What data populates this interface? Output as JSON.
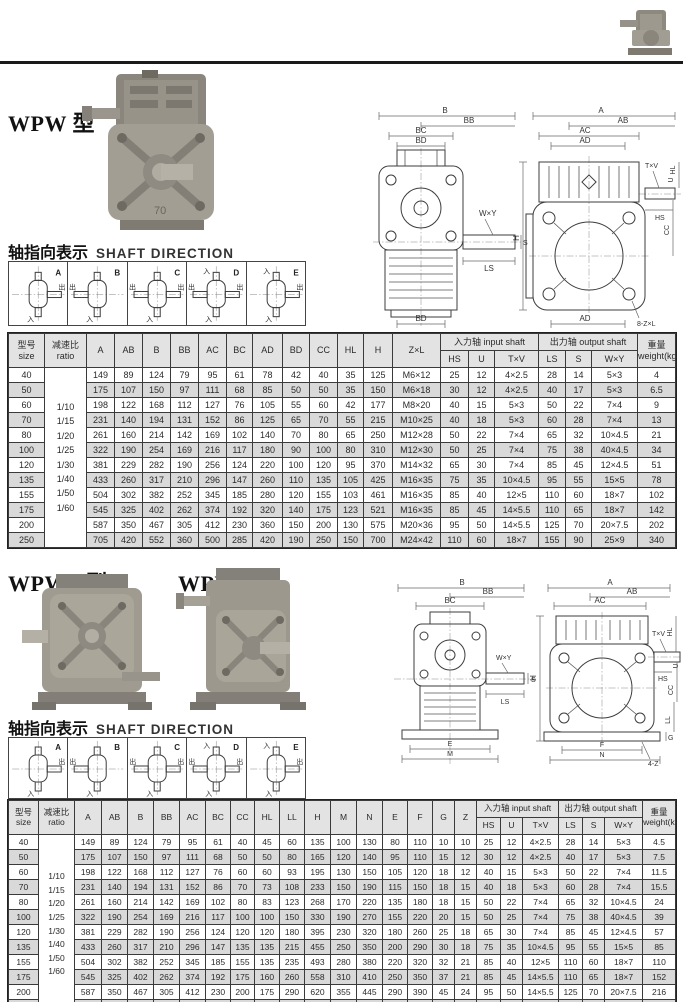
{
  "sections": {
    "wpw": {
      "title": "WPW 型"
    },
    "wpwa": {
      "title": "WPWA 型"
    },
    "wpws": {
      "title": "WPWS 型"
    }
  },
  "photos": {
    "wpw_case_label": "70"
  },
  "shaft_direction": {
    "label_zh": "轴指向表示",
    "label_en": "SHAFT DIRECTION",
    "in_char": "入",
    "out_char": "出",
    "cells": [
      {
        "letter": "A",
        "top_in": false,
        "left_out": false,
        "right_out": true
      },
      {
        "letter": "B",
        "top_in": false,
        "left_out": true,
        "right_out": false
      },
      {
        "letter": "C",
        "top_in": false,
        "left_out": true,
        "right_out": true
      },
      {
        "letter": "D",
        "top_in": true,
        "left_out": true,
        "right_out": true
      },
      {
        "letter": "E",
        "top_in": true,
        "left_out": false,
        "right_out": true
      }
    ]
  },
  "drawings1": {
    "front": {
      "b": "B",
      "bb": "BB",
      "bc": "BC",
      "bd": "BD",
      "wxy": "W×Y",
      "s": "S",
      "ls": "LS",
      "bd_bottom": "BD"
    },
    "side": {
      "a": "A",
      "ab": "AB",
      "ac": "AC",
      "ad": "AD",
      "h": "H",
      "txv": "T×V",
      "u": "U",
      "hl": "HL",
      "hs": "HS",
      "cc": "CC",
      "ad_bottom": "AD",
      "zl": "8-Z×L"
    }
  },
  "drawings2": {
    "front": {
      "b": "B",
      "bb": "BB",
      "bc": "BC",
      "wxy": "W×Y",
      "s": "S",
      "ls": "LS",
      "e": "E",
      "m": "M"
    },
    "side": {
      "a": "A",
      "ab": "AB",
      "ac": "AC",
      "h": "H",
      "txv": "T×V",
      "u": "U",
      "hl": "HL",
      "hs": "HS",
      "cc": "CC",
      "ll": "LL",
      "g": "G",
      "f": "F",
      "n": "N",
      "z": "4-Z"
    }
  },
  "table1": {
    "head": {
      "groups": [
        {
          "t": "型号\nsize",
          "rs": 2
        },
        {
          "t": "减速比\nratio",
          "rs": 2
        },
        {
          "t": "A",
          "rs": 2
        },
        {
          "t": "AB",
          "rs": 2
        },
        {
          "t": "B",
          "rs": 2
        },
        {
          "t": "BB",
          "rs": 2
        },
        {
          "t": "AC",
          "rs": 2
        },
        {
          "t": "BC",
          "rs": 2
        },
        {
          "t": "AD",
          "rs": 2
        },
        {
          "t": "BD",
          "rs": 2
        },
        {
          "t": "CC",
          "rs": 2
        },
        {
          "t": "HL",
          "rs": 2
        },
        {
          "t": "H",
          "rs": 2
        },
        {
          "t": "Z×L",
          "rs": 2
        },
        {
          "t": "入力轴 input shaft",
          "cs": 3
        },
        {
          "t": "出力轴 output shaft",
          "cs": 3
        },
        {
          "t": "重量\nweight(kg)",
          "rs": 2
        }
      ],
      "subs": [
        "HS",
        "U",
        "T×V",
        "LS",
        "S",
        "W×Y"
      ]
    },
    "ratio_values": [
      "1/10",
      "1/15",
      "1/20",
      "1/25",
      "1/30",
      "1/40",
      "1/50",
      "1/60"
    ],
    "rows": [
      {
        "size": "40",
        "cells": [
          "149",
          "89",
          "124",
          "79",
          "95",
          "61",
          "78",
          "42",
          "40",
          "35",
          "125",
          "M6×12",
          "25",
          "12",
          "4×2.5",
          "28",
          "14",
          "5×3",
          "4"
        ]
      },
      {
        "size": "50",
        "cells": [
          "175",
          "107",
          "150",
          "97",
          "111",
          "68",
          "85",
          "50",
          "50",
          "35",
          "150",
          "M6×18",
          "30",
          "12",
          "4×2.5",
          "40",
          "17",
          "5×3",
          "6.5"
        ]
      },
      {
        "size": "60",
        "cells": [
          "198",
          "122",
          "168",
          "112",
          "127",
          "76",
          "105",
          "55",
          "60",
          "42",
          "177",
          "M8×20",
          "40",
          "15",
          "5×3",
          "50",
          "22",
          "7×4",
          "9"
        ]
      },
      {
        "size": "70",
        "cells": [
          "231",
          "140",
          "194",
          "131",
          "152",
          "86",
          "125",
          "65",
          "70",
          "55",
          "215",
          "M10×25",
          "40",
          "18",
          "5×3",
          "60",
          "28",
          "7×4",
          "13"
        ]
      },
      {
        "size": "80",
        "cells": [
          "261",
          "160",
          "214",
          "142",
          "169",
          "102",
          "140",
          "70",
          "80",
          "65",
          "250",
          "M12×28",
          "50",
          "22",
          "7×4",
          "65",
          "32",
          "10×4.5",
          "21"
        ]
      },
      {
        "size": "100",
        "cells": [
          "322",
          "190",
          "254",
          "169",
          "216",
          "117",
          "180",
          "90",
          "100",
          "80",
          "310",
          "M12×30",
          "50",
          "25",
          "7×4",
          "75",
          "38",
          "40×4.5",
          "34"
        ]
      },
      {
        "size": "120",
        "cells": [
          "381",
          "229",
          "282",
          "190",
          "256",
          "124",
          "220",
          "100",
          "120",
          "95",
          "370",
          "M14×32",
          "65",
          "30",
          "7×4",
          "85",
          "45",
          "12×4.5",
          "51"
        ]
      },
      {
        "size": "135",
        "cells": [
          "433",
          "260",
          "317",
          "210",
          "296",
          "147",
          "260",
          "110",
          "135",
          "105",
          "425",
          "M16×35",
          "75",
          "35",
          "10×4.5",
          "95",
          "55",
          "15×5",
          "78"
        ]
      },
      {
        "size": "155",
        "cells": [
          "504",
          "302",
          "382",
          "252",
          "345",
          "185",
          "280",
          "120",
          "155",
          "103",
          "461",
          "M16×35",
          "85",
          "40",
          "12×5",
          "110",
          "60",
          "18×7",
          "102"
        ]
      },
      {
        "size": "175",
        "cells": [
          "545",
          "325",
          "402",
          "262",
          "374",
          "192",
          "320",
          "140",
          "175",
          "123",
          "521",
          "M16×35",
          "85",
          "45",
          "14×5.5",
          "110",
          "65",
          "18×7",
          "142"
        ]
      },
      {
        "size": "200",
        "cells": [
          "587",
          "350",
          "467",
          "305",
          "412",
          "230",
          "360",
          "150",
          "200",
          "130",
          "575",
          "M20×36",
          "95",
          "50",
          "14×5.5",
          "125",
          "70",
          "20×7.5",
          "202"
        ]
      },
      {
        "size": "250",
        "cells": [
          "705",
          "420",
          "552",
          "360",
          "500",
          "285",
          "420",
          "190",
          "250",
          "150",
          "700",
          "M24×42",
          "110",
          "60",
          "18×7",
          "155",
          "90",
          "25×9",
          "340"
        ]
      }
    ]
  },
  "table2": {
    "head": {
      "groups": [
        {
          "t": "型号\nsize",
          "rs": 2
        },
        {
          "t": "减速比\nratio",
          "rs": 2
        },
        {
          "t": "A",
          "rs": 2
        },
        {
          "t": "AB",
          "rs": 2
        },
        {
          "t": "B",
          "rs": 2
        },
        {
          "t": "BB",
          "rs": 2
        },
        {
          "t": "AC",
          "rs": 2
        },
        {
          "t": "BC",
          "rs": 2
        },
        {
          "t": "CC",
          "rs": 2
        },
        {
          "t": "HL",
          "rs": 2
        },
        {
          "t": "LL",
          "rs": 2
        },
        {
          "t": "H",
          "rs": 2
        },
        {
          "t": "M",
          "rs": 2
        },
        {
          "t": "N",
          "rs": 2
        },
        {
          "t": "E",
          "rs": 2
        },
        {
          "t": "F",
          "rs": 2
        },
        {
          "t": "G",
          "rs": 2
        },
        {
          "t": "Z",
          "rs": 2
        },
        {
          "t": "入力轴 input shaft",
          "cs": 3
        },
        {
          "t": "出力轴 output shaft",
          "cs": 3
        },
        {
          "t": "重量\nweight(kg)",
          "rs": 2
        }
      ],
      "subs": [
        "HS",
        "U",
        "T×V",
        "LS",
        "S",
        "W×Y"
      ]
    },
    "ratio_values": [
      "1/10",
      "1/15",
      "1/20",
      "1/25",
      "1/30",
      "1/40",
      "1/50",
      "1/60"
    ],
    "rows": [
      {
        "size": "40",
        "cells": [
          "149",
          "89",
          "124",
          "79",
          "95",
          "61",
          "40",
          "45",
          "60",
          "135",
          "100",
          "130",
          "80",
          "110",
          "10",
          "10",
          "25",
          "12",
          "4×2.5",
          "28",
          "14",
          "5×3",
          "4.5"
        ]
      },
      {
        "size": "50",
        "cells": [
          "175",
          "107",
          "150",
          "97",
          "111",
          "68",
          "50",
          "50",
          "80",
          "165",
          "120",
          "140",
          "95",
          "110",
          "15",
          "12",
          "30",
          "12",
          "4×2.5",
          "40",
          "17",
          "5×3",
          "7.5"
        ]
      },
      {
        "size": "60",
        "cells": [
          "198",
          "122",
          "168",
          "112",
          "127",
          "76",
          "60",
          "60",
          "93",
          "195",
          "130",
          "150",
          "105",
          "120",
          "18",
          "12",
          "40",
          "15",
          "5×3",
          "50",
          "22",
          "7×4",
          "11.5"
        ]
      },
      {
        "size": "70",
        "cells": [
          "231",
          "140",
          "194",
          "131",
          "152",
          "86",
          "70",
          "73",
          "108",
          "233",
          "150",
          "190",
          "115",
          "150",
          "18",
          "15",
          "40",
          "18",
          "5×3",
          "60",
          "28",
          "7×4",
          "15.5"
        ]
      },
      {
        "size": "80",
        "cells": [
          "261",
          "160",
          "214",
          "142",
          "169",
          "102",
          "80",
          "83",
          "123",
          "268",
          "170",
          "220",
          "135",
          "180",
          "18",
          "15",
          "50",
          "22",
          "7×4",
          "65",
          "32",
          "10×4.5",
          "24"
        ]
      },
      {
        "size": "100",
        "cells": [
          "322",
          "190",
          "254",
          "169",
          "216",
          "117",
          "100",
          "100",
          "150",
          "330",
          "190",
          "270",
          "155",
          "220",
          "20",
          "15",
          "50",
          "25",
          "7×4",
          "75",
          "38",
          "40×4.5",
          "39"
        ]
      },
      {
        "size": "120",
        "cells": [
          "381",
          "229",
          "282",
          "190",
          "256",
          "124",
          "120",
          "120",
          "180",
          "395",
          "230",
          "320",
          "180",
          "260",
          "25",
          "18",
          "65",
          "30",
          "7×4",
          "85",
          "45",
          "12×4.5",
          "57"
        ]
      },
      {
        "size": "135",
        "cells": [
          "433",
          "260",
          "317",
          "210",
          "296",
          "147",
          "135",
          "135",
          "215",
          "455",
          "250",
          "350",
          "200",
          "290",
          "30",
          "18",
          "75",
          "35",
          "10×4.5",
          "95",
          "55",
          "15×5",
          "85"
        ]
      },
      {
        "size": "155",
        "cells": [
          "504",
          "302",
          "382",
          "252",
          "345",
          "185",
          "155",
          "135",
          "235",
          "493",
          "280",
          "380",
          "220",
          "320",
          "32",
          "21",
          "85",
          "40",
          "12×5",
          "110",
          "60",
          "18×7",
          "110"
        ]
      },
      {
        "size": "175",
        "cells": [
          "545",
          "325",
          "402",
          "262",
          "374",
          "192",
          "175",
          "160",
          "260",
          "558",
          "310",
          "410",
          "250",
          "350",
          "37",
          "21",
          "85",
          "45",
          "14×5.5",
          "110",
          "65",
          "18×7",
          "152"
        ]
      },
      {
        "size": "200",
        "cells": [
          "587",
          "350",
          "467",
          "305",
          "412",
          "230",
          "200",
          "175",
          "290",
          "620",
          "355",
          "445",
          "290",
          "390",
          "45",
          "24",
          "95",
          "50",
          "14×5.5",
          "125",
          "70",
          "20×7.5",
          "216"
        ]
      },
      {
        "size": "250",
        "cells": [
          "705",
          "420",
          "552",
          "360",
          "500",
          "285",
          "250",
          "200",
          "350",
          "750",
          "460",
          "560",
          "380",
          "480",
          "50",
          "28",
          "110",
          "60",
          "18×7",
          "155",
          "90",
          "25×9",
          "350"
        ]
      }
    ]
  }
}
